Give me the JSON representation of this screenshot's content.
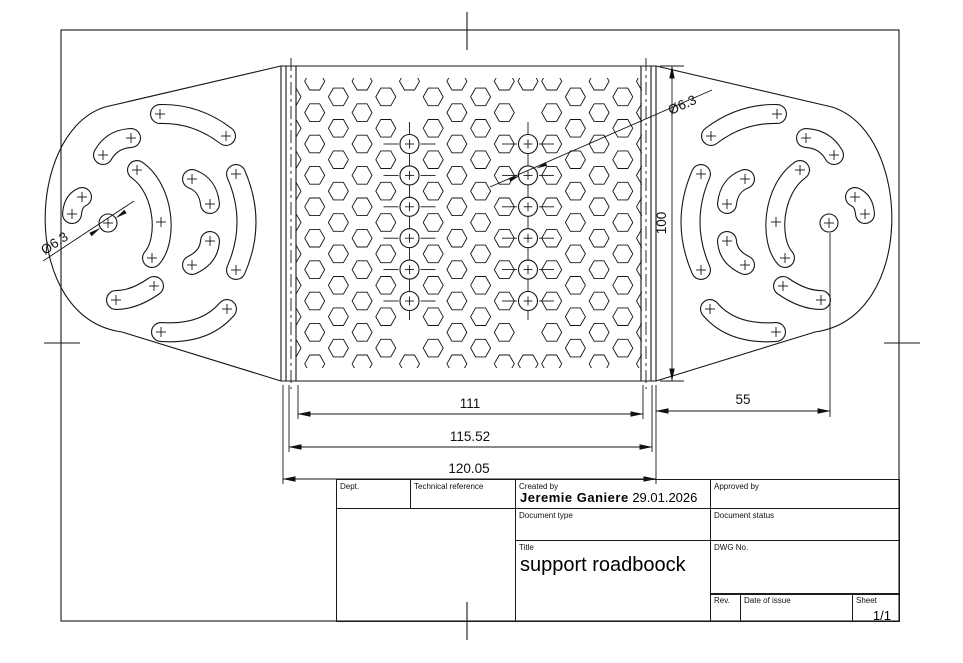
{
  "drawing": {
    "dimensions": {
      "inner_width": "111",
      "mid_width": "115.52",
      "outer_width": "120.05",
      "end_offset": "55",
      "height": "100",
      "hole_dia_left": "Ø6.3",
      "hole_dia_right": "Ø6.3"
    },
    "title_block": {
      "dept_label": "Dept.",
      "technical_reference_label": "Technical reference",
      "created_by_label": "Created by",
      "created_by_name": "Jeremie Ganiere",
      "created_date": "29.01.2026",
      "approved_by_label": "Approved by",
      "document_type_label": "Document type",
      "document_status_label": "Document status",
      "title_label": "Title",
      "title": "support roadboock",
      "dwg_no_label": "DWG No.",
      "rev_label": "Rev.",
      "date_of_issue_label": "Date of issue",
      "sheet_label": "Sheet",
      "sheet_value": "1/1"
    }
  }
}
